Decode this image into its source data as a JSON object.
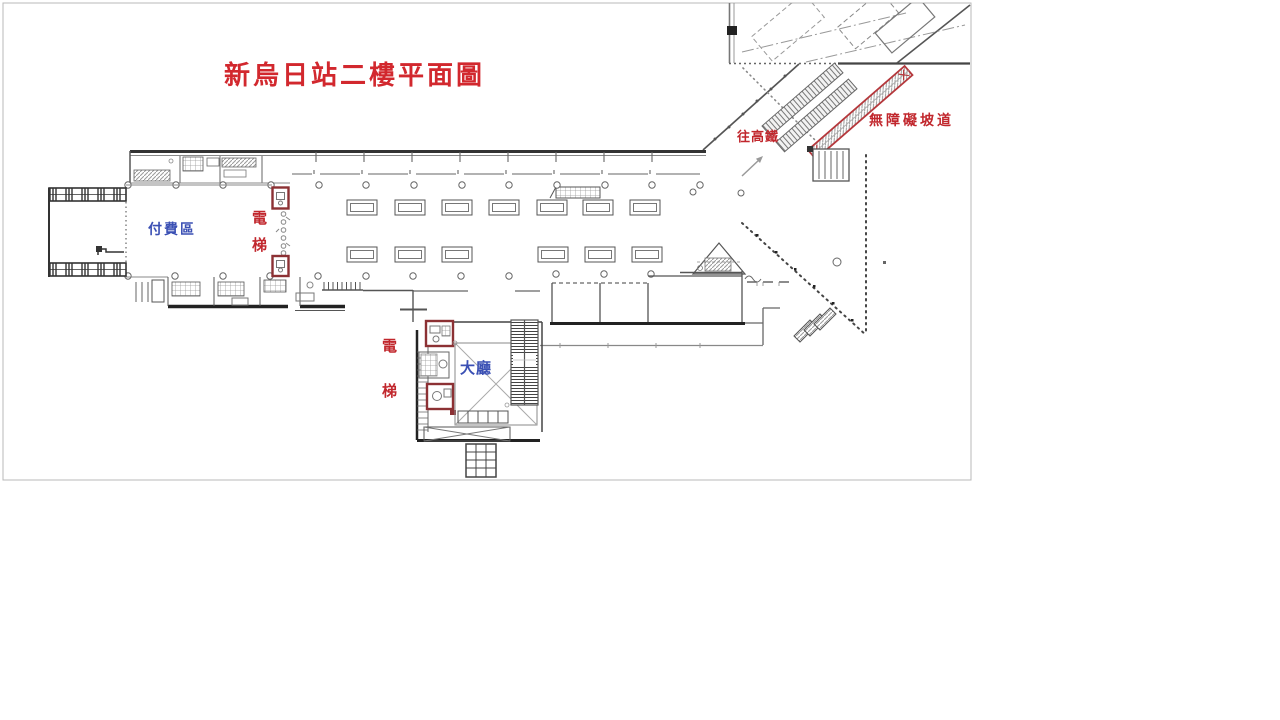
{
  "page": {
    "background": "#ffffff"
  },
  "plan": {
    "title": {
      "text": "新烏日站二樓平面圖",
      "color": "#d2282e"
    },
    "labels": {
      "to_hsr": {
        "text": "往高鐵",
        "color": "#c1272d"
      },
      "accessible_ramp": {
        "text": "無障礙坡道",
        "color": "#c1272d"
      },
      "paid_area": {
        "text": "付費區",
        "color": "#3b50b4"
      },
      "elevator_concourse": {
        "text": "電梯",
        "color": "#c1272d",
        "orientation": "vertical"
      },
      "elevator_lobby": {
        "text": "電梯",
        "color": "#c1272d",
        "orientation": "vertical"
      },
      "hall": {
        "text": "大廳",
        "color": "#3b50b4"
      }
    },
    "highlight_colors": {
      "elevator_box_outline": "#8c3134",
      "ramp_outline": "#b5383c",
      "drawing_line": "#555555"
    }
  }
}
